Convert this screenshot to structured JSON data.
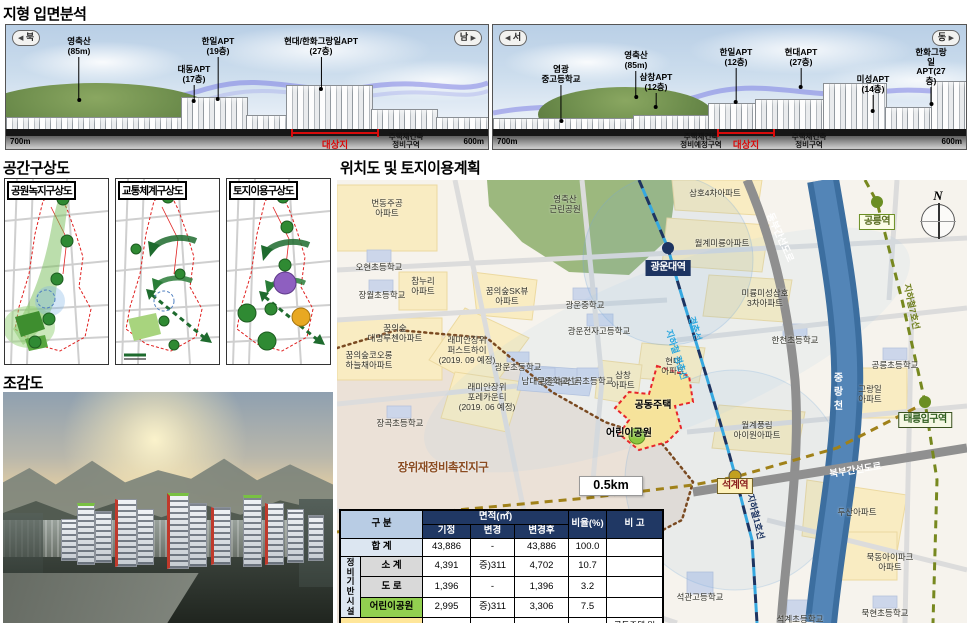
{
  "icons": {
    "arrow_left": "◀",
    "arrow_right": "▶"
  },
  "terrain": {
    "title": "지형 입면분석",
    "a": {
      "dir_left": "북",
      "dir_right": "남",
      "callouts": [
        "영축산\n(85m)",
        "대동APT\n(17층)",
        "한일APT\n(19층)",
        "현대/한화그랑일APT\n(27층)"
      ],
      "scale_left": "700m",
      "scale_right": "600m",
      "site": "대상지",
      "zone_right": "주택재건축\n정비구역"
    },
    "b": {
      "dir_left": "서",
      "dir_right": "동",
      "callouts": [
        "영축산\n(85m)",
        "염광\n중고등학교",
        "삼창APT\n(12층)",
        "한일APT\n(12층)",
        "현대APT\n(27층)",
        "미성APT\n(14층)",
        "한화그랑일\nAPT(27층)"
      ],
      "scale_left": "700m",
      "scale_right": "600m",
      "site": "대상지",
      "zone_left": "주택재건축\n정비예정구역",
      "zone_right": "주택재건축\n정비구역"
    }
  },
  "concept": {
    "title": "공간구상도",
    "maps": [
      "공원녹지구상도",
      "교통체계구상도",
      "토지이용구상도"
    ]
  },
  "birdseye": {
    "title": "조감도"
  },
  "location": {
    "title": "위치도 및 토지이용계획",
    "scale_label": "0.5km",
    "district_label": "장위재정비촉진지구",
    "site_label": "공동주택",
    "park_label": "어린이공원",
    "river_label": "중랑천",
    "compass_label": "N",
    "stations": {
      "gwangwoon": "광운대역",
      "gongneung": "공릉역",
      "taereung": "태릉입구역",
      "seokgye": "석계역"
    },
    "line_labels": {
      "gyeongchun": "경춘선",
      "gyeongchun2": "지하철 경춘선",
      "line1": "지하철1호선",
      "line7": "지하철7호선"
    },
    "road_labels": {
      "dongbu": "동부간선도로",
      "bukbu": "북부간선도로"
    },
    "labels": [
      "번동주공\n아파트",
      "영축산\n근린공원",
      "삼호4차아파트",
      "월계미룡아파트",
      "오현초등학교",
      "참누리\n아파트",
      "장월초등학교",
      "꿈의숲SK뷰\n아파트",
      "광운중학교",
      "미륭미성삼호\n3차아파트",
      "꿈의숲\n대명루첸아파트",
      "광운전자고등학교",
      "래미안장위\n퍼스트하이\n(2019. 09 예정)",
      "꿈의숲코오롱\n하늘채아파트",
      "한천초등학교",
      "광운대학교",
      "현대\n아파트",
      "삼창\n아파트",
      "광운초등학교",
      "남대문중학교",
      "선곡초등학교",
      "래미안장위\n포레카운티\n(2019. 06 예정)",
      "그랑일\n아파트",
      "장곡초등학교",
      "월계풍림\n아이원아파트",
      "두산아파트",
      "공릉초등학교",
      "묵동아이파크\n아파트",
      "묵현초등학교",
      "석관고등학교",
      "석계초등학교"
    ]
  },
  "table": {
    "col_group": "구 분",
    "col_area": "면적(㎡)",
    "col_sub": [
      "기정",
      "변경",
      "변경후"
    ],
    "col_ratio": "비율(%)",
    "col_note": "비 고",
    "group_label": "정비\n기반\n시설",
    "rows": {
      "total": {
        "label": "합   계",
        "v1": "43,886",
        "v2": "-",
        "v3": "43,886",
        "r": "100.0",
        "note": ""
      },
      "sub": {
        "label": "소  계",
        "v1": "4,391",
        "v2": "증)311",
        "v3": "4,702",
        "r": "10.7",
        "note": ""
      },
      "road": {
        "label": "도  로",
        "v1": "1,396",
        "v2": "-",
        "v3": "1,396",
        "r": "3.2",
        "note": ""
      },
      "park": {
        "label": "어린이공원",
        "v1": "2,995",
        "v2": "증)311",
        "v3": "3,306",
        "r": "7.5",
        "note": ""
      },
      "lot": {
        "label": "획지",
        "v1": "39,495",
        "v2": "감)311",
        "v3": "39,184",
        "r": "89.3",
        "note": "공동주택 및\n부대복리시설"
      }
    }
  }
}
